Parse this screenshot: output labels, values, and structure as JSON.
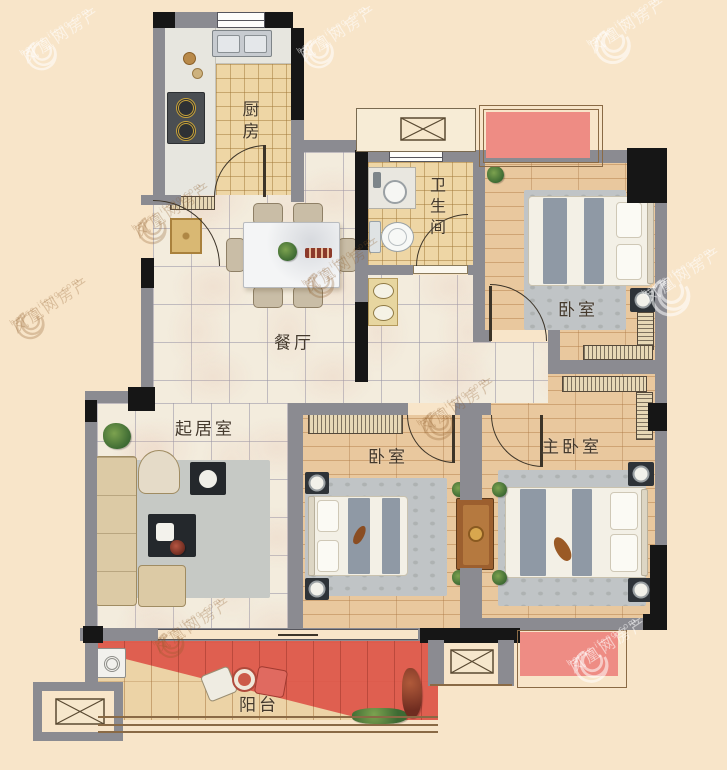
{
  "rooms": {
    "kitchen": {
      "label": "厨房"
    },
    "bathroom": {
      "label": "卫生间"
    },
    "dining": {
      "label": "餐厅"
    },
    "living": {
      "label": "起居室"
    },
    "bedroom_north": {
      "label": "卧室"
    },
    "bedroom_south": {
      "label": "卧室"
    },
    "master": {
      "label": "主卧室"
    },
    "balcony": {
      "label": "阳台"
    }
  },
  "watermark": {
    "brand": "凤凰网房产",
    "domain": "house.ifeng.com"
  },
  "colors": {
    "bg": "#f8e5c9",
    "wall": "#8b8b91",
    "blk": "#161616",
    "marble": "#f3ecdd",
    "wood": "#e9c89e",
    "tile": "#eed6a5",
    "red": "#de5549",
    "pink": "#ee8c84",
    "rug": "#c0c4c6",
    "arc": "#3c3428"
  }
}
